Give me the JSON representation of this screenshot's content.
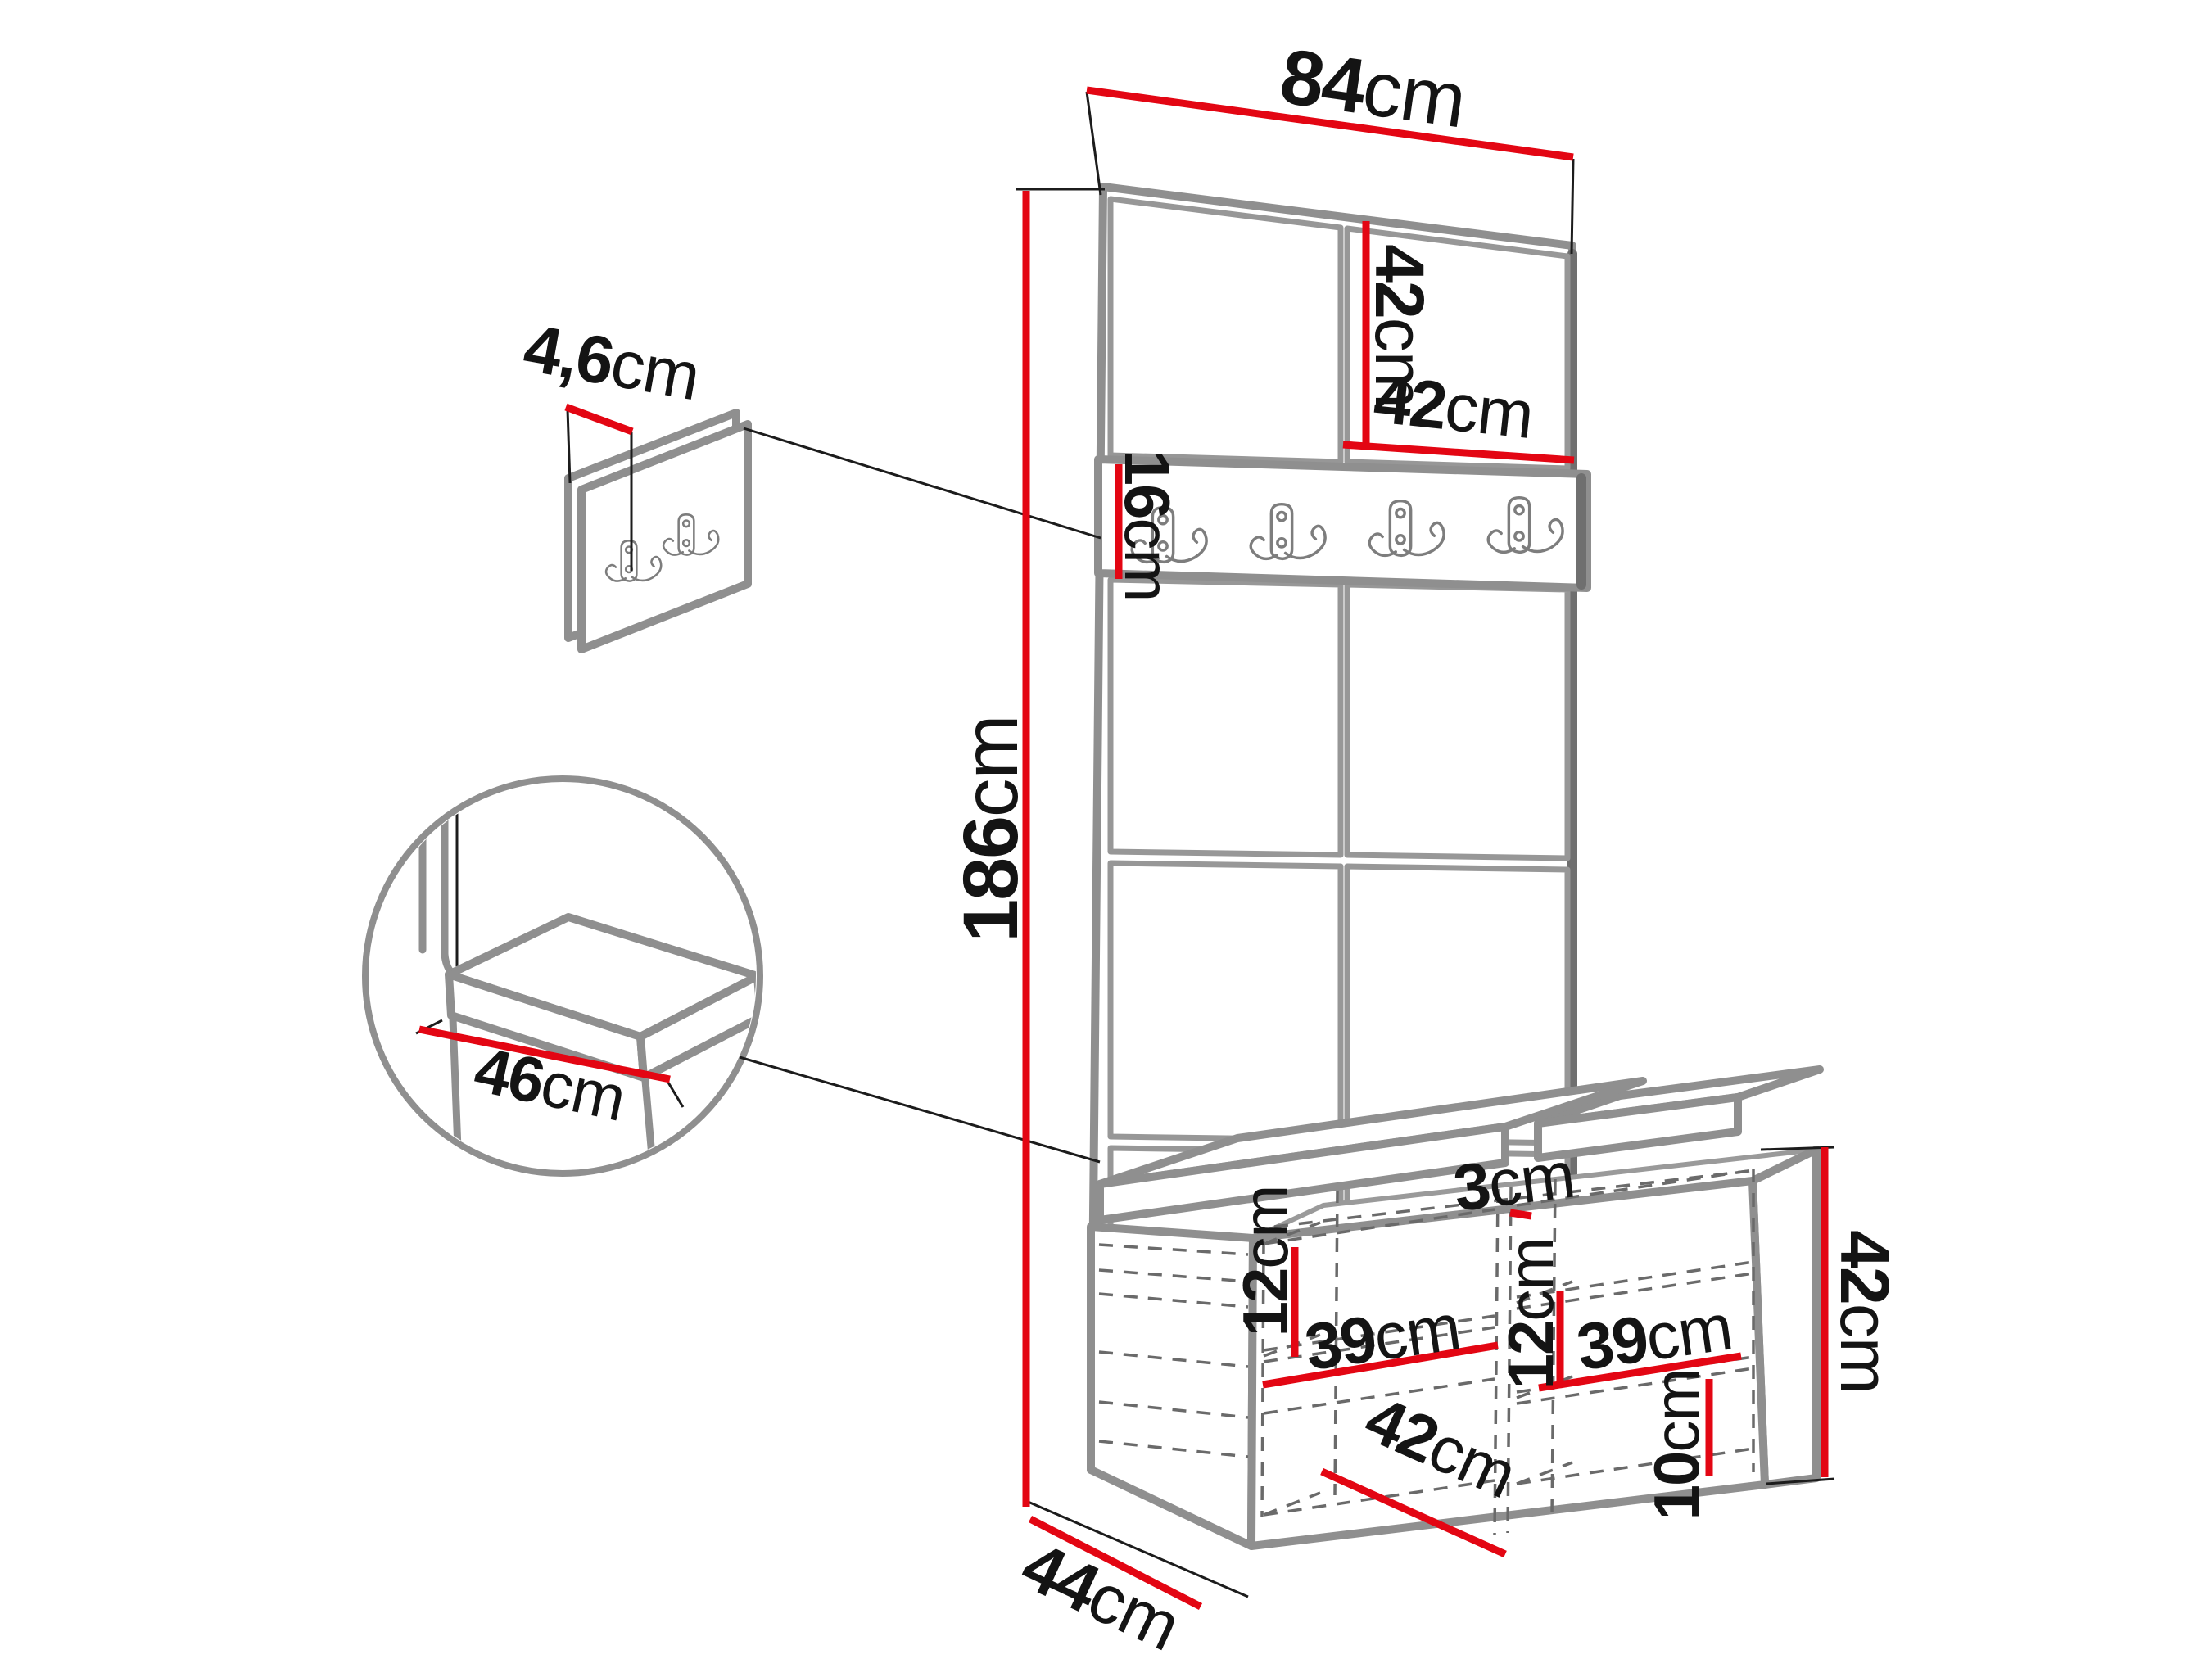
{
  "diagram": {
    "type": "furniture-dimension-drawing",
    "subject": "hallway set: padded wall panel with hook rail, wall hook panel, storage bench with seat cushions",
    "unit": "cm",
    "colors": {
      "dimension_accent": "#e30613",
      "outline": "#8f8f8f",
      "hidden_line": "#6a6a6a",
      "text": "#141414",
      "background": "#ffffff"
    },
    "icons": {
      "hook": "double-coat-hook"
    }
  },
  "dimensions": {
    "top_width": {
      "value": "84",
      "unit": "cm"
    },
    "tile_height": {
      "value": "42",
      "unit": "cm"
    },
    "tile_width": {
      "value": "42",
      "unit": "cm"
    },
    "rail_height": {
      "value": "16",
      "unit": "cm"
    },
    "total_height": {
      "value": "186",
      "unit": "cm"
    },
    "panel_thickness": {
      "value": "4,6",
      "unit": "cm"
    },
    "seat_depth": {
      "value": "46",
      "unit": "cm"
    },
    "cushion_gap": {
      "value": "3",
      "unit": "cm"
    },
    "left_shelf_drop": {
      "value": "12",
      "unit": "cm"
    },
    "left_shelf_width": {
      "value": "39",
      "unit": "cm"
    },
    "right_shelf_drop": {
      "value": "12",
      "unit": "cm"
    },
    "right_shelf_width": {
      "value": "39",
      "unit": "cm"
    },
    "bottom_gap": {
      "value": "10",
      "unit": "cm"
    },
    "bench_height": {
      "value": "42",
      "unit": "cm"
    },
    "bench_inner_width": {
      "value": "42",
      "unit": "cm"
    },
    "bench_depth": {
      "value": "44",
      "unit": "cm"
    }
  }
}
